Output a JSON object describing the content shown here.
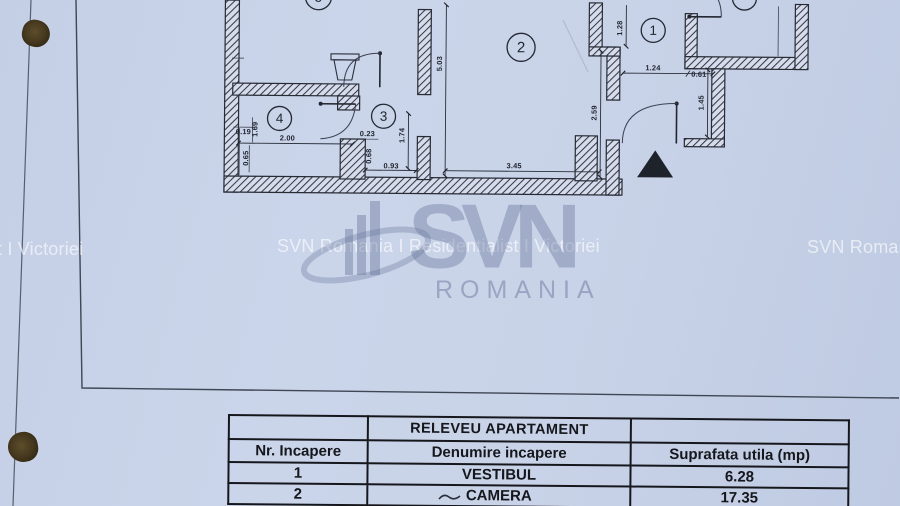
{
  "page": {
    "paper_color": "#c9d3e8",
    "ink_color": "#23272f"
  },
  "watermark": {
    "tile_left": "t I Victoriei",
    "tile_center": "SVN Romania I Residentialist I Victoriei",
    "tile_right": "SVN Roma",
    "logo_text": "SVN",
    "logo_subtext": "ROMANIA",
    "text_color": "rgba(255,255,255,0.62)",
    "logo_color": "rgba(100,115,152,0.45)"
  },
  "plan": {
    "rooms": {
      "r1": "1",
      "r2": "2",
      "r3": "3",
      "r4": "4",
      "r5": "5",
      "r6": ""
    },
    "dims": {
      "d503": "5.03",
      "d174": "1.74",
      "d259": "2.59",
      "d128": "1.28",
      "d145": "1.45",
      "d124": "1.24",
      "d061": "0.61",
      "d200": "2.00",
      "d019": "0.19",
      "d169": "1.69",
      "d065": "0.65",
      "d023": "0.23",
      "d068": "0.68",
      "d093": "0.93",
      "d345": "3.45"
    }
  },
  "table": {
    "title": "RELEVEU APARTAMENT",
    "headers": [
      "Nr. Incapere",
      "Denumire incapere",
      "Suprafata utila (mp)"
    ],
    "rows": [
      {
        "nr": "1",
        "name": "VESTIBUL",
        "area": "6.28"
      },
      {
        "nr": "2",
        "name": "CAMERA",
        "area": "17.35"
      }
    ]
  }
}
